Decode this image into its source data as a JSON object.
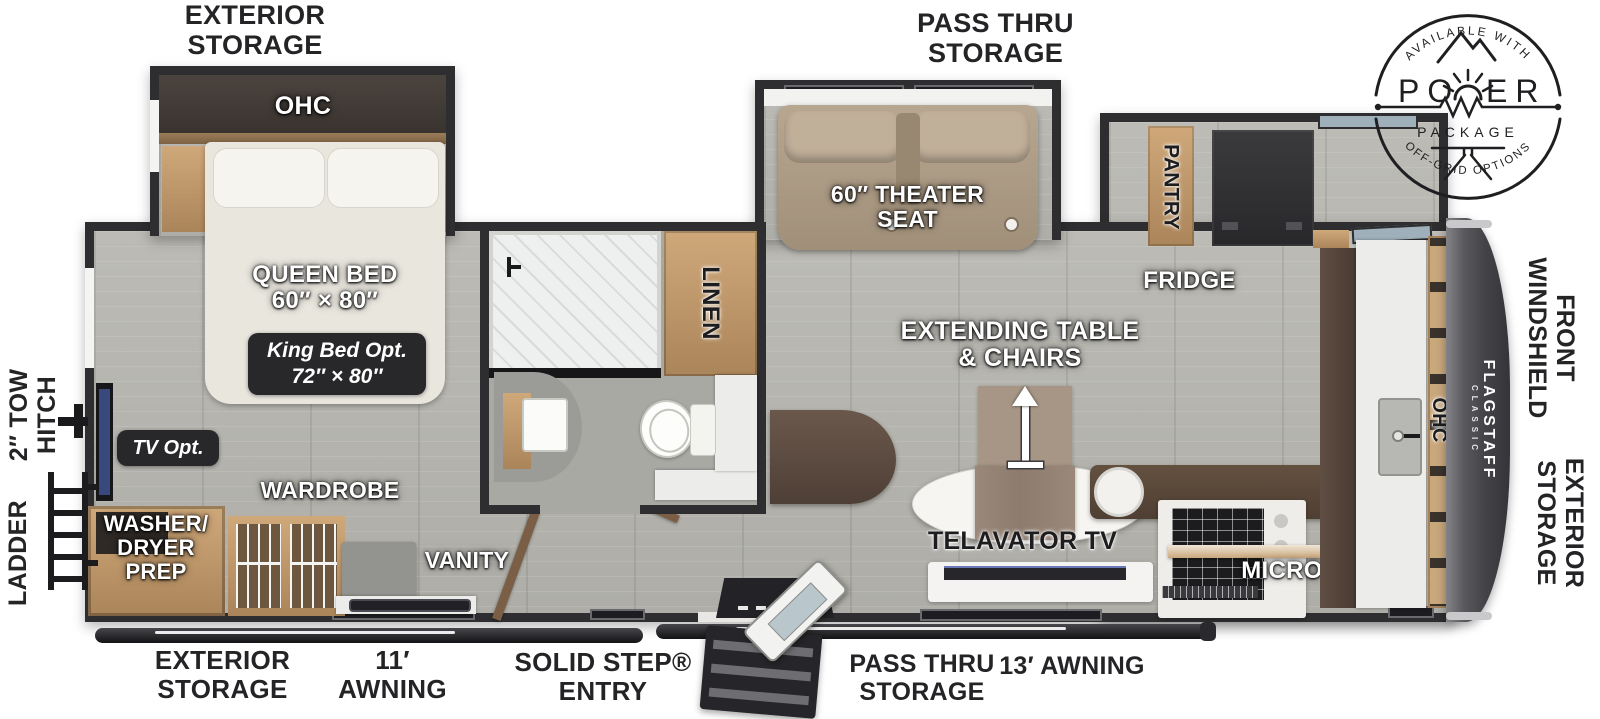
{
  "meta": {
    "type": "rv-floorplan",
    "brand": "FLAGSTAFF",
    "series": "CLASSIC"
  },
  "colors": {
    "wall": "#2e2d2f",
    "floor": "#b7b6b0",
    "wood": "#c2996b",
    "badge_dark": "#28282a",
    "front_cap": "#434347",
    "label_dark": "#242427",
    "label_white": "#ffffff"
  },
  "labels": {
    "top": {
      "exterior_storage": "EXTERIOR\nSTORAGE",
      "pass_thru": "PASS THRU\nSTORAGE"
    },
    "left": {
      "tow_hitch": "2″ TOW\nHITCH",
      "ladder": "LADDER"
    },
    "right": {
      "front_windshield": "FRONT\nWINDSHIELD",
      "exterior_storage": "EXTERIOR\nSTORAGE"
    },
    "bottom": {
      "exterior_storage": "EXTERIOR\nSTORAGE",
      "awning11": "11′\nAWNING",
      "solid_step": "SOLID STEP®\nENTRY",
      "pass_thru": "PASS THRU\nSTORAGE",
      "awning13": "13′ AWNING"
    },
    "bedroom": {
      "ohc": "OHC",
      "queen": "QUEEN BED\n60″ × 80″",
      "king_opt": "King Bed Opt.\n72″ × 80″",
      "tv_opt": "TV Opt.",
      "wardrobe": "WARDROBE",
      "washer": "WASHER/\nDRYER\nPREP",
      "vanity": "VANITY"
    },
    "bath": {
      "linen": "LINEN"
    },
    "living": {
      "theater": "60″ THEATER\nSEAT",
      "extending": "EXTENDING TABLE\n& CHAIRS",
      "telavator": "TELAVATOR TV"
    },
    "kitchen": {
      "pantry": "PANTRY",
      "fridge": "FRIDGE",
      "micro": "MICRO",
      "ohc": "OHC"
    },
    "front_cap": {
      "brand": "FLAGSTAFF",
      "series": "CLASSIC"
    }
  },
  "logo": {
    "top_arc": "AVAILABLE WITH",
    "power_left": "PO",
    "power_right": "ER",
    "package": "PACKAGE",
    "bottom_arc": "OFF-GRID OPTIONS"
  }
}
